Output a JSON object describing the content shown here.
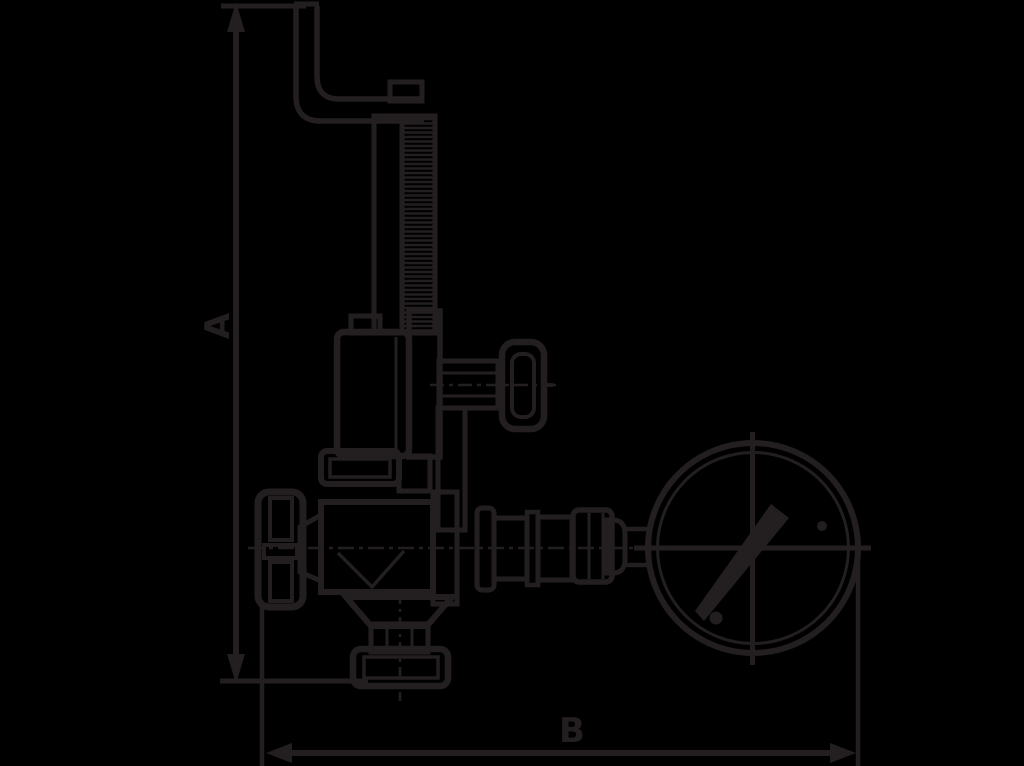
{
  "canvas": {
    "width": 1024,
    "height": 766,
    "background_color": "#000000",
    "ink_color": "#231F20"
  },
  "drawing": {
    "kind": "technical dimension drawing",
    "subject": "safety valve with test lever, side handwheel, outlet flange and pressure gauge (side view)",
    "labels": {
      "dim_a": "A",
      "dim_b": "B"
    },
    "dimensions": [
      {
        "label": "A",
        "orientation": "vertical",
        "extent": "overall height of valve assembly"
      },
      {
        "label": "B",
        "orientation": "horizontal",
        "extent": "overall width from front handwheel to outer edge of gauge"
      }
    ],
    "parts": [
      "test-lever",
      "spindle-with-spring",
      "spring-housing",
      "side-handwheel",
      "bonnet-flange",
      "valve-body",
      "front-handwheel",
      "outlet-flange",
      "gauge-piping",
      "pressure-gauge"
    ]
  }
}
